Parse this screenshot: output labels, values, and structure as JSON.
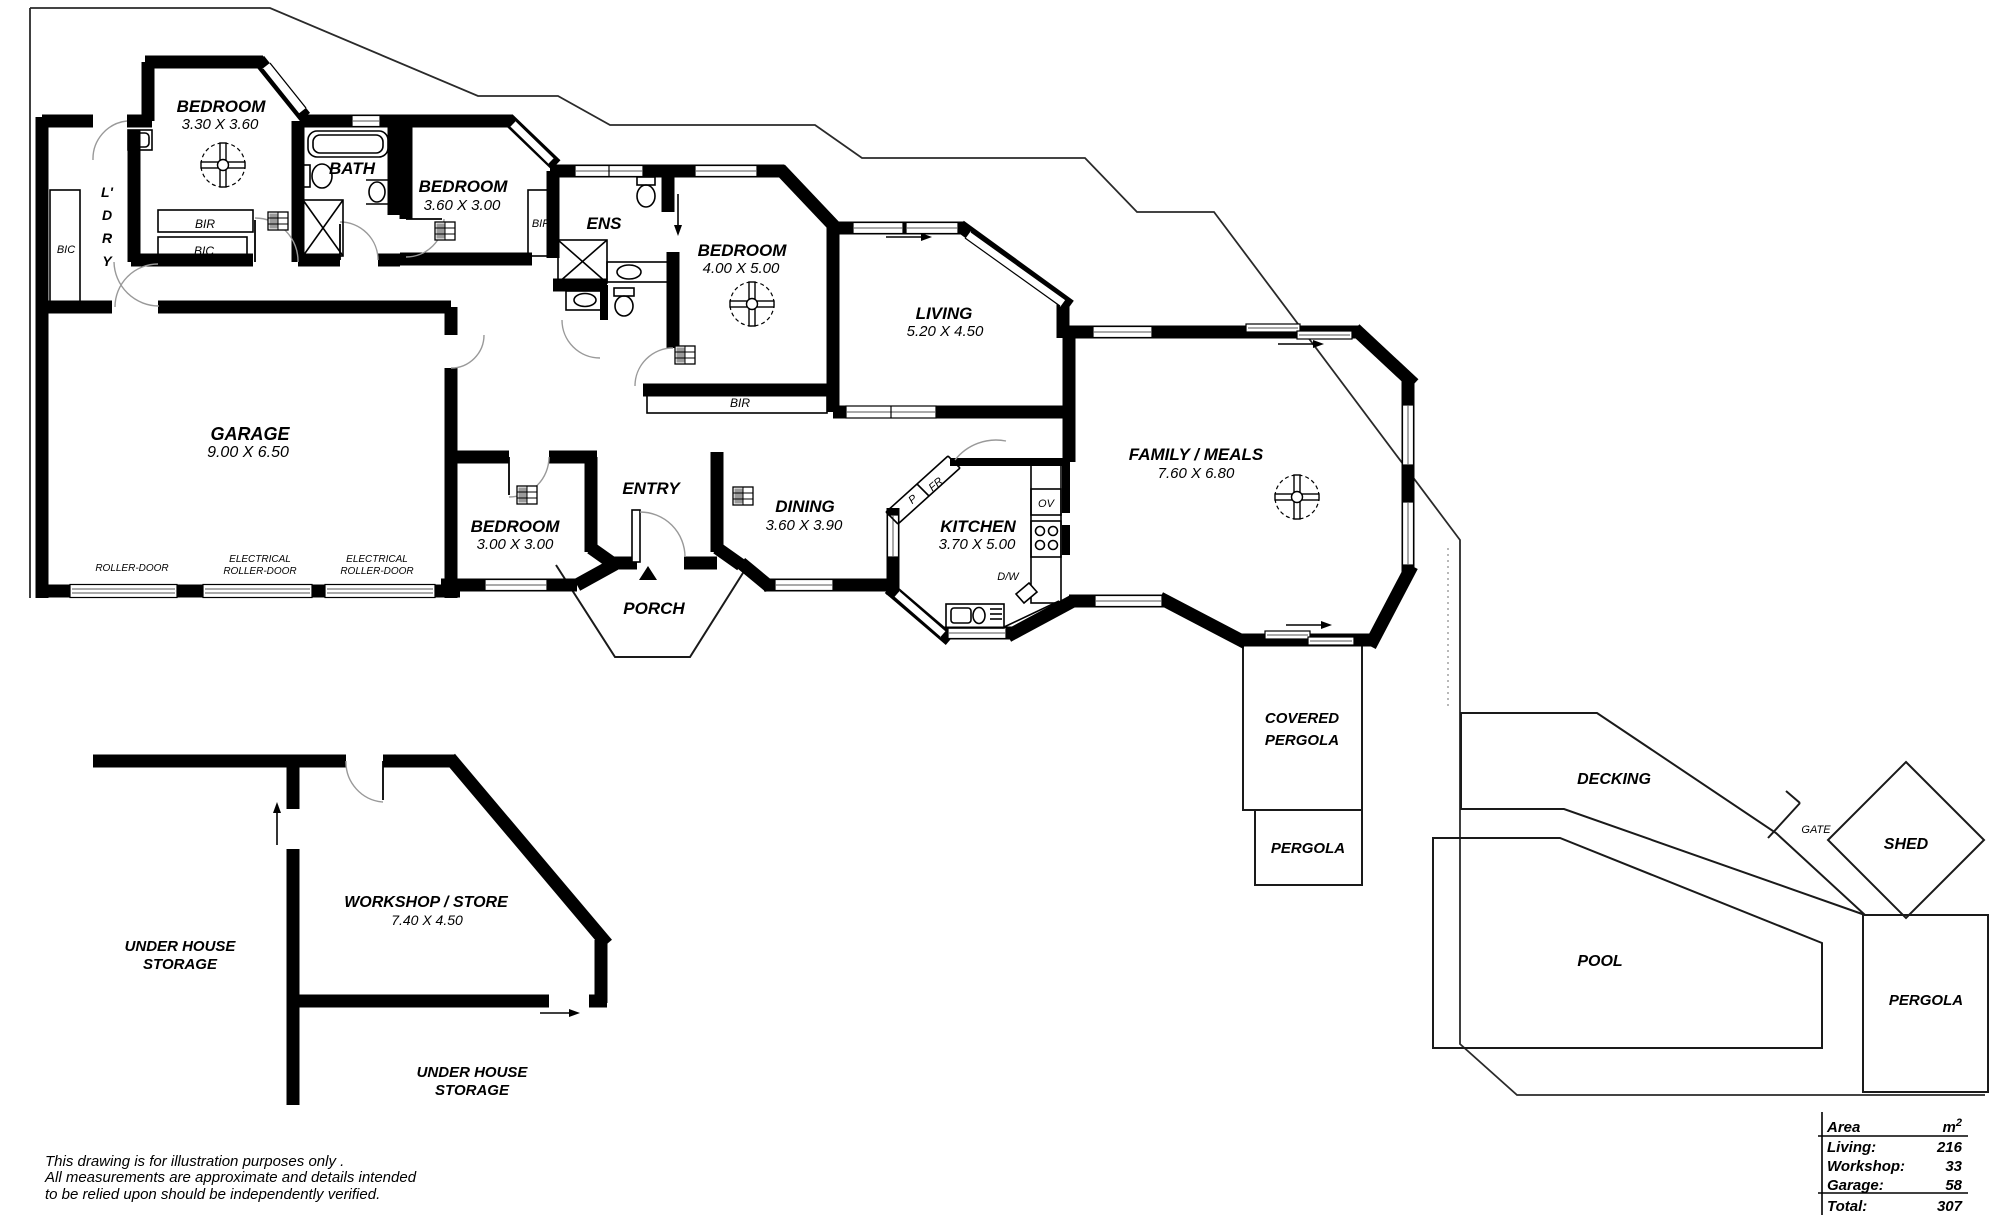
{
  "plan": {
    "bedroom1": {
      "name": "BEDROOM",
      "dims": "3.30 X 3.60"
    },
    "bath": {
      "name": "BATH"
    },
    "laundry": {
      "l1": "L'",
      "l2": "D",
      "l3": "R",
      "l4": "Y"
    },
    "bic_left": {
      "name": "BIC"
    },
    "bir1": {
      "name": "BIR"
    },
    "bic1": {
      "name": "BIC"
    },
    "bedroom2": {
      "name": "BEDROOM",
      "dims": "3.60 X 3.00"
    },
    "bir2": {
      "name": "BIR"
    },
    "ens": {
      "name": "ENS"
    },
    "bedroom3": {
      "name": "BEDROOM",
      "dims": "4.00 X 5.00"
    },
    "bir3": {
      "name": "BIR"
    },
    "living": {
      "name": "LIVING",
      "dims": "5.20 X 4.50"
    },
    "garage": {
      "name": "GARAGE",
      "dims": "9.00 X 6.50"
    },
    "roller_door": {
      "name": "ROLLER-DOOR"
    },
    "elec_roller": {
      "line1": "ELECTRICAL",
      "line2": "ROLLER-DOOR"
    },
    "bedroom4": {
      "name": "BEDROOM",
      "dims": "3.00 X 3.00"
    },
    "entry": {
      "name": "ENTRY"
    },
    "porch": {
      "name": "PORCH"
    },
    "dining": {
      "name": "DINING",
      "dims": "3.60 X 3.90"
    },
    "kitchen": {
      "name": "KITCHEN",
      "dims": "3.70 X 5.00",
      "fr": "FR",
      "p": "P",
      "ov": "OV",
      "dw": "D/W"
    },
    "family": {
      "name": "FAMILY / MEALS",
      "dims": "7.60 X 6.80"
    },
    "covered_pergola": {
      "line1": "COVERED",
      "line2": "PERGOLA"
    },
    "pergola_house": {
      "name": "PERGOLA"
    },
    "decking": {
      "name": "DECKING"
    },
    "gate": {
      "name": "GATE"
    },
    "shed": {
      "name": "SHED"
    },
    "pool": {
      "name": "POOL"
    },
    "pergola_pool": {
      "name": "PERGOLA"
    },
    "workshop": {
      "name": "WORKSHOP / STORE",
      "dims": "7.40 X 4.50"
    },
    "storage1": {
      "line1": "UNDER HOUSE",
      "line2": "STORAGE"
    },
    "storage2": {
      "line1": "UNDER HOUSE",
      "line2": "STORAGE"
    }
  },
  "disclaimer": {
    "line1": "This drawing is for illustration purposes only .",
    "line2": "All measurements are approximate and details intended",
    "line3": "to be relied upon should be independently verified."
  },
  "area_table": {
    "header": {
      "label": "Area",
      "unit": "m",
      "unit_sup": "2"
    },
    "rows": [
      {
        "label": "Living:",
        "value": "216"
      },
      {
        "label": "Workshop:",
        "value": "33"
      },
      {
        "label": "Garage:",
        "value": "58"
      }
    ],
    "total": {
      "label": "Total:",
      "value": "307"
    }
  }
}
